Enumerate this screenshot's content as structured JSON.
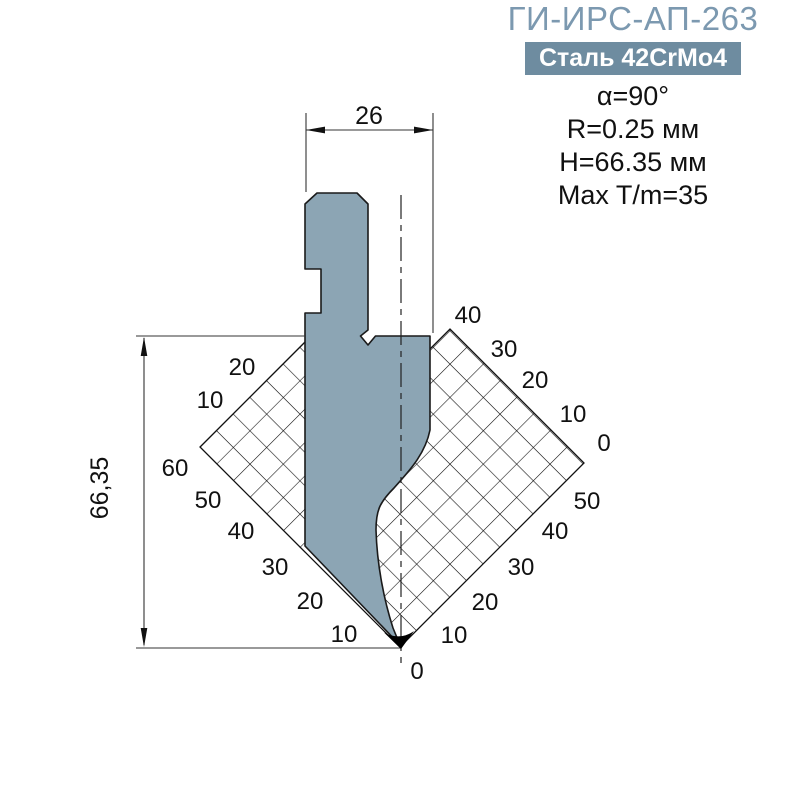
{
  "header": {
    "title": "ГИ-ИРС-АП-263",
    "material_badge": "Сталь 42CrMo4"
  },
  "specs": {
    "lines": [
      "α=90°",
      "R=0.25 мм",
      "H=66.35 мм",
      "Max T/m=35"
    ]
  },
  "dimensions": {
    "width_label": "26",
    "height_label": "66,35"
  },
  "scales": {
    "upper_left": [
      "20",
      "10"
    ],
    "upper_right": [
      "40",
      "30",
      "20",
      "10",
      "0"
    ],
    "lower_left": [
      "60",
      "50",
      "40",
      "30",
      "20",
      "10"
    ],
    "lower_right": [
      "50",
      "40",
      "30",
      "20",
      "10"
    ],
    "origin": "0"
  },
  "colors": {
    "title_accent": "#7C99B0",
    "badge_bg": "#6E8CA0",
    "badge_text": "#FFFFFF",
    "punch_fill": "#8CA5B4",
    "tip_fill": "#000000",
    "line": "#1A1A1A"
  }
}
